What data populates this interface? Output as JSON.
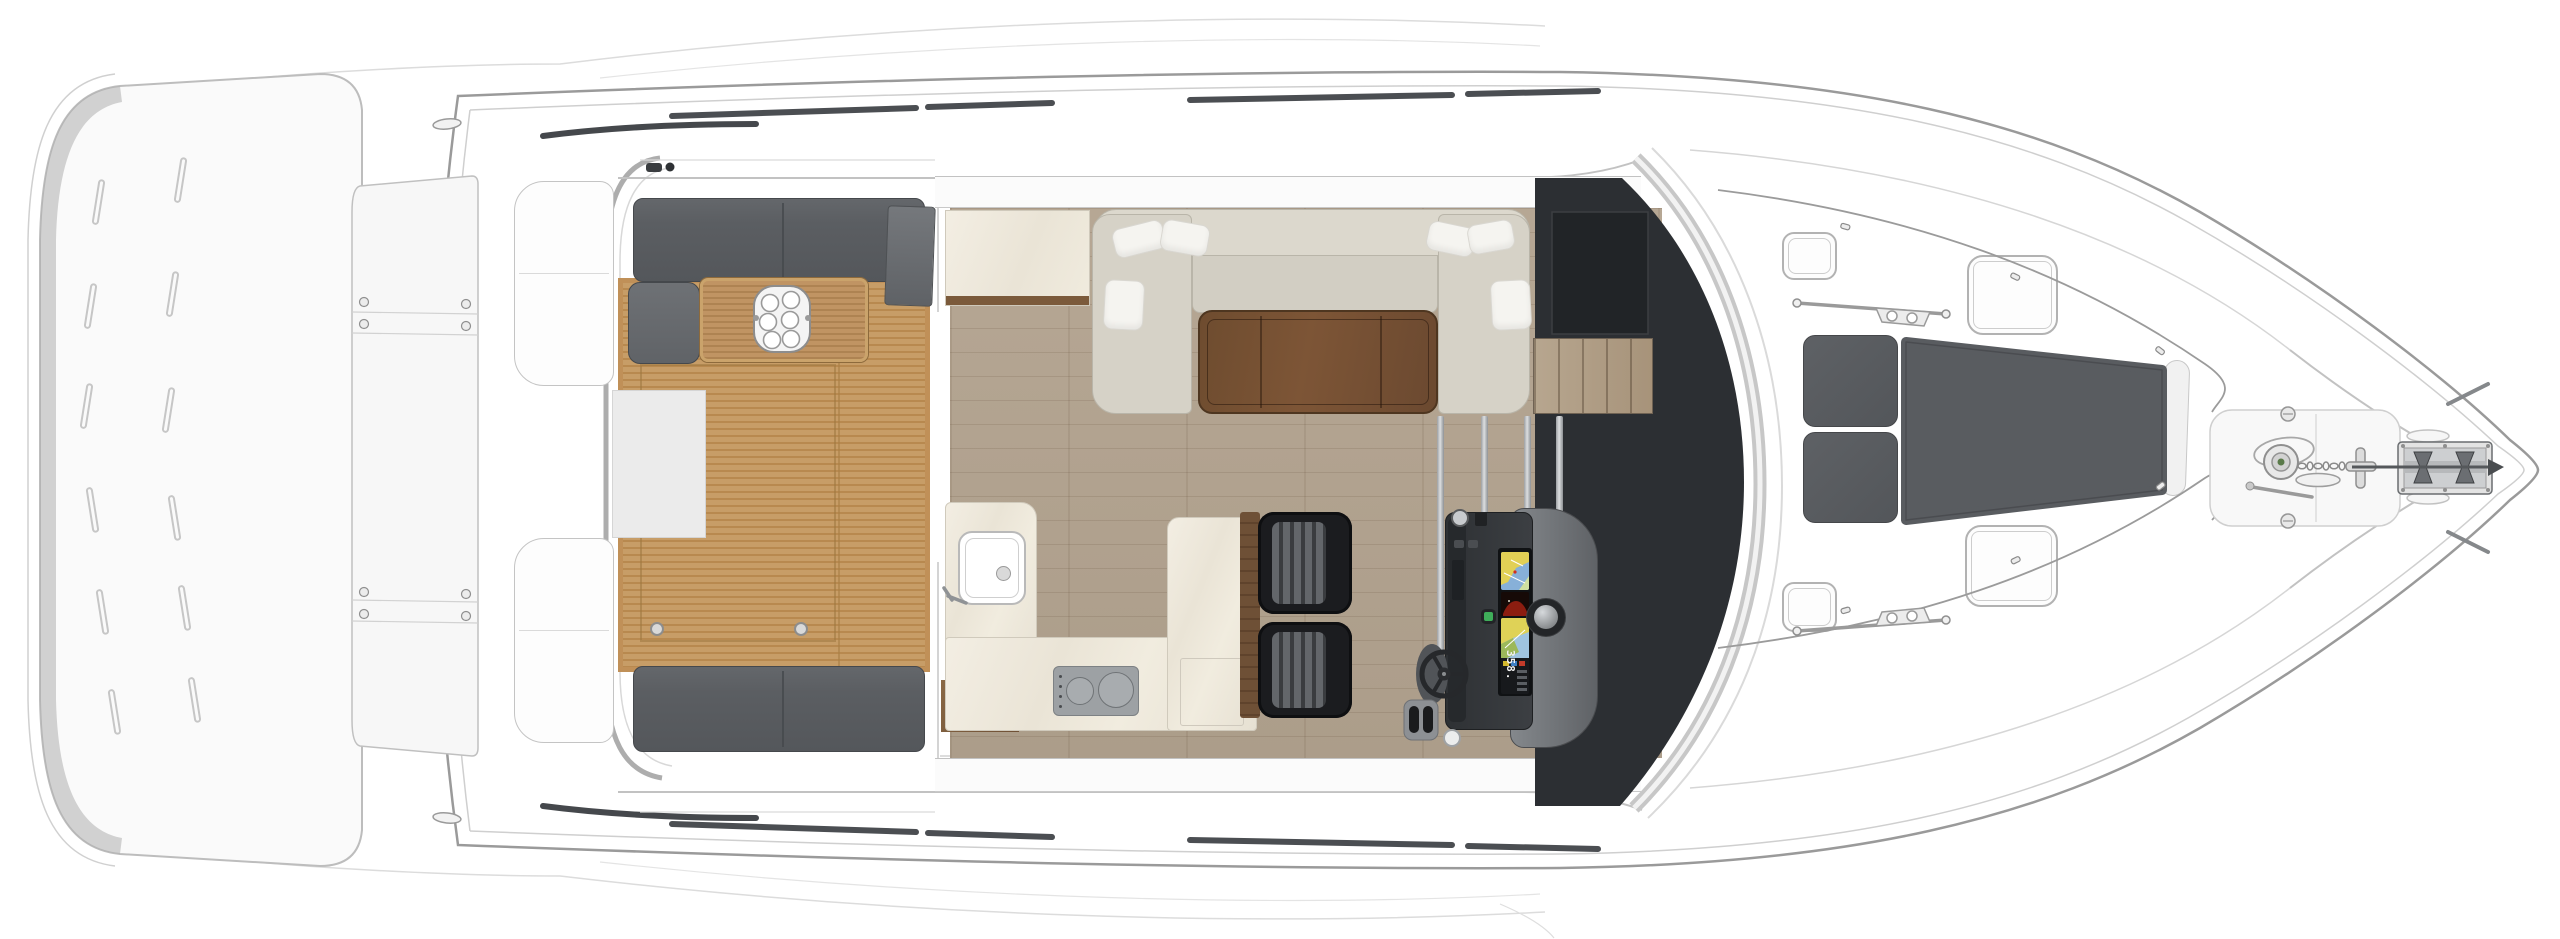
{
  "figure": {
    "type": "yacht-deck-plan-top-view"
  },
  "helm": {
    "heading_readout": "358.",
    "displays": [
      "chartplotter-upper",
      "engine-display",
      "chartplotter-lower"
    ],
    "controls": [
      "steering-wheel",
      "throttle-levers",
      "trackball",
      "green-power-button"
    ]
  },
  "regions": {
    "stern": [
      "swim-platform",
      "engine-hatch",
      "transom-lockers"
    ],
    "cockpit": [
      "aft-bench",
      "forward-bench",
      "corner-cushion",
      "teak-table",
      "glass-tray",
      "teak-deck"
    ],
    "galley": [
      "sink",
      "faucet",
      "two-burner-cooktop",
      "counter",
      "peninsula",
      "aft-cabinet"
    ],
    "salon": [
      "u-shaped-sofa",
      "six-pillows",
      "walnut-hi-lo-table",
      "wood-floor",
      "companionway-stairs"
    ],
    "helm": [
      "console",
      "two-helm-seats",
      "windshield"
    ],
    "foredeck": [
      "four-deck-hatches",
      "three-sun-pads",
      "grab-rails",
      "two-horn-cleats"
    ],
    "bow": [
      "windlass",
      "anchor-chain",
      "cross-cleat",
      "anchor-roller",
      "deck-fills"
    ]
  },
  "palette": {
    "paper": "#ffffff",
    "hull_stroke": "#9a9a9a",
    "line_light": "#cccccc",
    "platform_fill": "#fafafa",
    "platform_shade": "#aeaeae",
    "teak_base": "#c79d67",
    "teak_stripe": "#b8894f",
    "teak_trim": "#c09058",
    "teak_table": "#b8905a",
    "upholstery_gray": "#5b5e62",
    "upholstery_seam": "#45484c",
    "sofa_base": "#d6d2c7",
    "sofa_back": "#dcd8cd",
    "pillow": "#f5f4f0",
    "walnut_dark": "#6e4c2f",
    "walnut_light": "#82593a",
    "salon_floor": "#b2a390",
    "marble": "#f0ebe0",
    "marble_edge": "#d0cabc",
    "wood_trim": "#7b5a3b",
    "cooktop_gray": "#9da1a4",
    "charcoal": "#2c2f33",
    "charcoal_inset": "#212427",
    "console_dark": "#303337",
    "console_pod": "#7d8185",
    "seat_black": "#1b1c1f",
    "seat_rib": "#63666a",
    "pad_gray": "#595c60",
    "hatch_border": "#b2b2b2",
    "metal": "#9c9c9c",
    "screen_water": "#87b0d8",
    "screen_land": "#e2d055",
    "screen_red": "#8c1d10",
    "screen_dark": "#121417",
    "led_green": "#3fae5a"
  }
}
